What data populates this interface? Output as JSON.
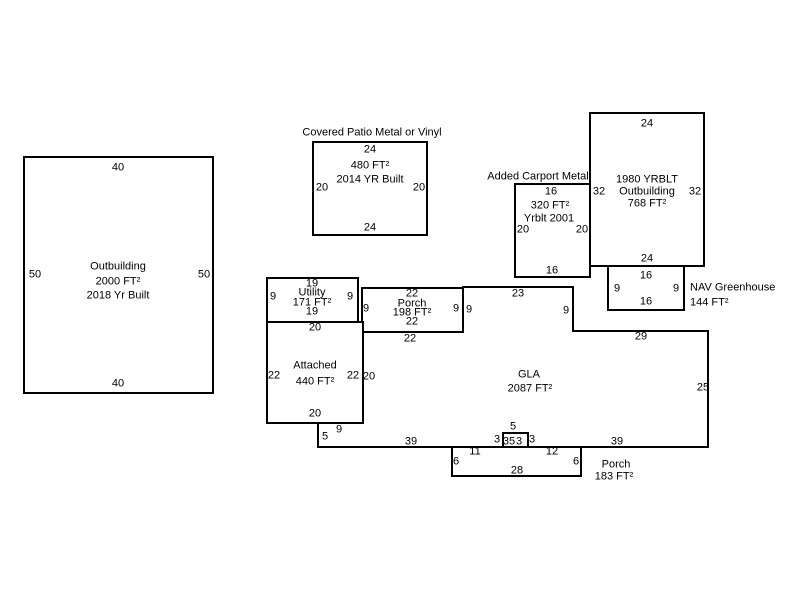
{
  "colors": {
    "line": "#000000",
    "text": "#000000",
    "background": "#ffffff"
  },
  "buildings": {
    "outbuilding_left": {
      "label": "Outbuilding",
      "area": "2000 FT²",
      "year_built": "2018 Yr Built",
      "dim_top": "40",
      "dim_bottom": "40",
      "dim_left": "50",
      "dim_right": "50"
    },
    "covered_patio": {
      "title": "Covered Patio Metal or Vinyl",
      "area": "480 FT²",
      "year_built": "2014 YR Built",
      "dim_top": "24",
      "dim_bottom": "24",
      "dim_left": "20",
      "dim_right": "20"
    },
    "carport": {
      "title": "Added Carport Metal",
      "area": "320 FT²",
      "year_built": "Yrblt 2001",
      "dim_top": "16",
      "dim_bottom": "16",
      "dim_left": "20",
      "dim_right": "20"
    },
    "outbuilding_1980": {
      "label_line1": "1980 YRBLT",
      "label_line2": "Outbuilding",
      "area": "768 FT²",
      "dim_top": "24",
      "dim_bottom": "24",
      "dim_left": "32",
      "dim_right": "32"
    },
    "greenhouse": {
      "label": "NAV Greenhouse",
      "area": "144 FT²",
      "dim_top": "16",
      "dim_bottom": "16",
      "dim_left": "9",
      "dim_right": "9"
    },
    "utility": {
      "label": "Utility",
      "area": "171 FT²",
      "dim_top": "19",
      "dim_bottom": "19",
      "dim_left": "9",
      "dim_right": "9"
    },
    "porch_upper": {
      "label": "Porch",
      "area": "198 FT²",
      "dim_top": "22",
      "dim_bottom": "22",
      "dim_left": "9",
      "dim_right": "9"
    },
    "attached": {
      "label": "Attached",
      "area": "440 FT²",
      "dim_top": "20",
      "dim_bottom": "20",
      "dim_left": "22",
      "dim_right": "22"
    },
    "gla": {
      "label": "GLA",
      "area": "2087 FT²",
      "dim_top_under_porch": "22",
      "dim_porch_step": "9",
      "dim_top": "23",
      "dim_right_step": "9",
      "dim_top_right": "29",
      "dim_right": "25",
      "dim_bottom_right": "39",
      "dim_bottom_left": "39",
      "dim_left": "20",
      "dim_notch_height": "5",
      "dim_notch_width": "9",
      "bump": {
        "top": "5",
        "left": "3",
        "right": "3",
        "inner_a": "35",
        "inner_b": "3"
      }
    },
    "porch_lower": {
      "label": "Porch",
      "area": "183 FT²",
      "dim_left": "6",
      "dim_right": "6",
      "dim_top_left": "11",
      "dim_top_right": "12",
      "dim_bottom": "28"
    }
  }
}
